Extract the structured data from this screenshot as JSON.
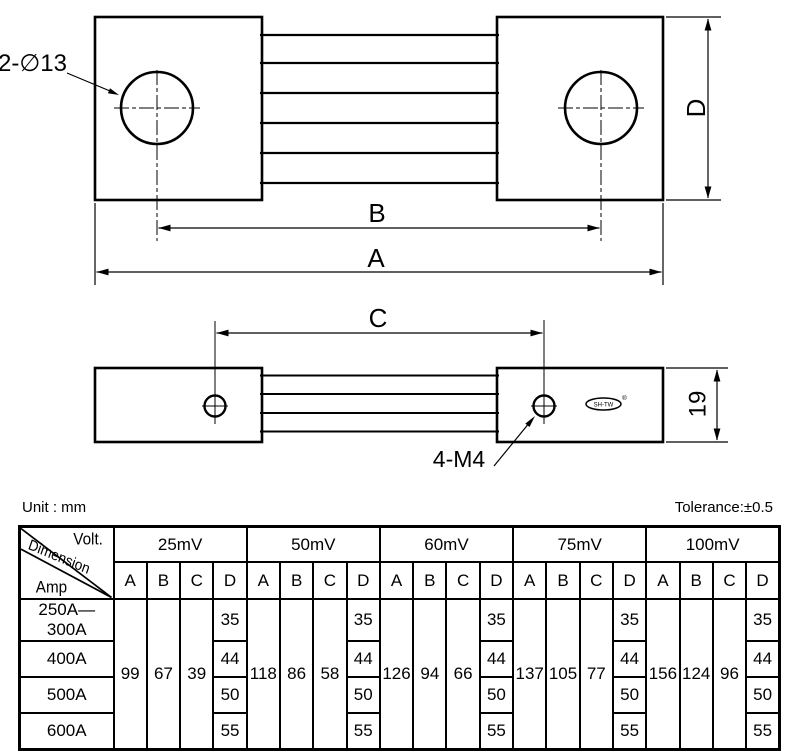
{
  "colors": {
    "line": "#000000",
    "background": "#ffffff"
  },
  "drawing": {
    "top_hole_callout": "2-∅13",
    "side_hole_callout": "4-M4",
    "dim_a": "A",
    "dim_b": "B",
    "dim_c": "C",
    "dim_d": "D",
    "side_thickness": "19",
    "logo_text": "SH-TW",
    "registered_mark": "®"
  },
  "notes": {
    "unit": "Unit : mm",
    "tolerance": "Tolerance:±0.5"
  },
  "table": {
    "corner": {
      "volt": "Volt.",
      "dimension": "Dimension",
      "amp": "Amp"
    },
    "sub_headers": [
      "A",
      "B",
      "C",
      "D"
    ],
    "groups": [
      {
        "label": "25mV",
        "A": "99",
        "B": "67",
        "C": "39"
      },
      {
        "label": "50mV",
        "A": "118",
        "B": "86",
        "C": "58"
      },
      {
        "label": "60mV",
        "A": "126",
        "B": "94",
        "C": "66"
      },
      {
        "label": "75mV",
        "A": "137",
        "B": "105",
        "C": "77"
      },
      {
        "label": "100mV",
        "A": "156",
        "B": "124",
        "C": "96"
      }
    ],
    "amp_rows": [
      {
        "label": "250A—300A",
        "D": "35"
      },
      {
        "label": "400A",
        "D": "44"
      },
      {
        "label": "500A",
        "D": "50"
      },
      {
        "label": "600A",
        "D": "55"
      }
    ]
  }
}
